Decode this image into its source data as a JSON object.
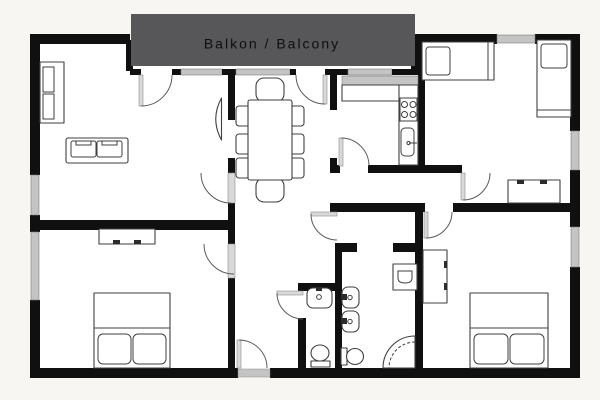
{
  "balcony": {
    "label": "Balkon / Balcony"
  },
  "colors": {
    "background": "#f7f6f3",
    "floor": "#ffffff",
    "wall": "#101010",
    "window_glass": "#c4c4c4",
    "balcony_fill": "#57575a",
    "balcony_text": "#0e0e0e",
    "furniture_stroke": "#3f3f3f",
    "door_arc": "#5a5a5a",
    "door_leaf": "#d9d9d9",
    "threshold": "#c4c4c4"
  },
  "symbols": [
    "wall-segment",
    "window-icon",
    "door-swing-icon",
    "entrance-door-icon",
    "wardrobe-icon",
    "sofa-icon",
    "tv-icon",
    "dining-table-icon",
    "chair-icon",
    "stove-icon",
    "kitchen-sink-icon",
    "single-bed-icon",
    "double-bed-icon",
    "desk-icon",
    "dresser-icon",
    "washbasin-icon",
    "toilet-icon",
    "corner-shower-icon",
    "washing-machine-icon"
  ]
}
